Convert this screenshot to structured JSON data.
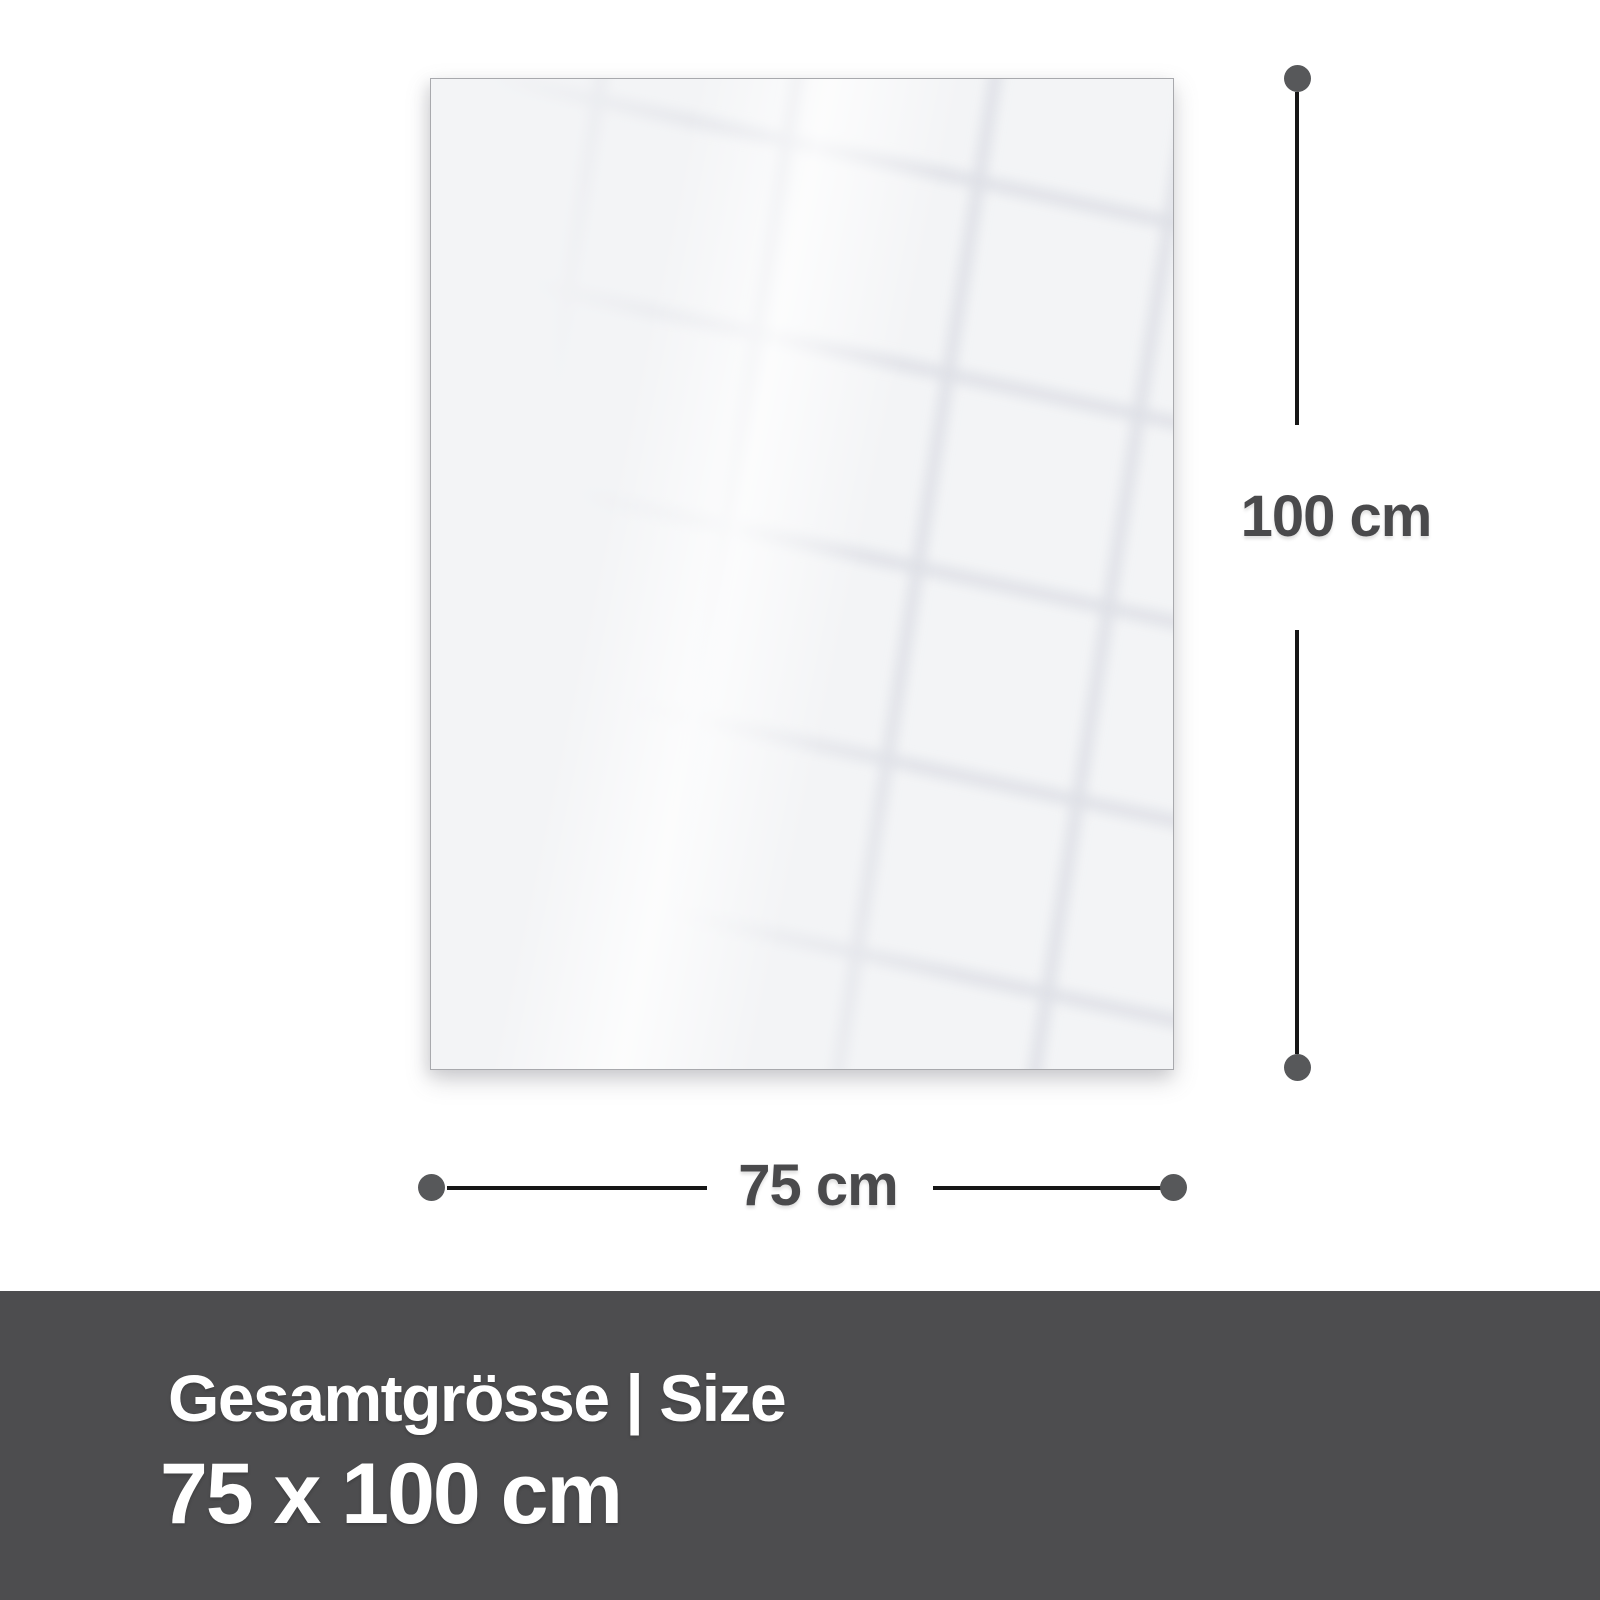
{
  "dimensions": {
    "height_label": "100 cm",
    "width_label": "75 cm"
  },
  "footer": {
    "title": "Gesamtgrösse | Size",
    "size_value": "75 x 100 cm"
  },
  "icons": {
    "dimension_endpoint": "filled-circle-dot"
  },
  "colors": {
    "page_background": "#ffffff",
    "panel_fill": "#f3f4f6",
    "panel_border": "#a8a9ad",
    "reflection_line": "#dbdde4",
    "dimension_line": "#161616",
    "dimension_dot": "#57585a",
    "dimension_text": "#4a4a4c",
    "footer_background": "#4d4d4f",
    "footer_text": "#ffffff"
  }
}
